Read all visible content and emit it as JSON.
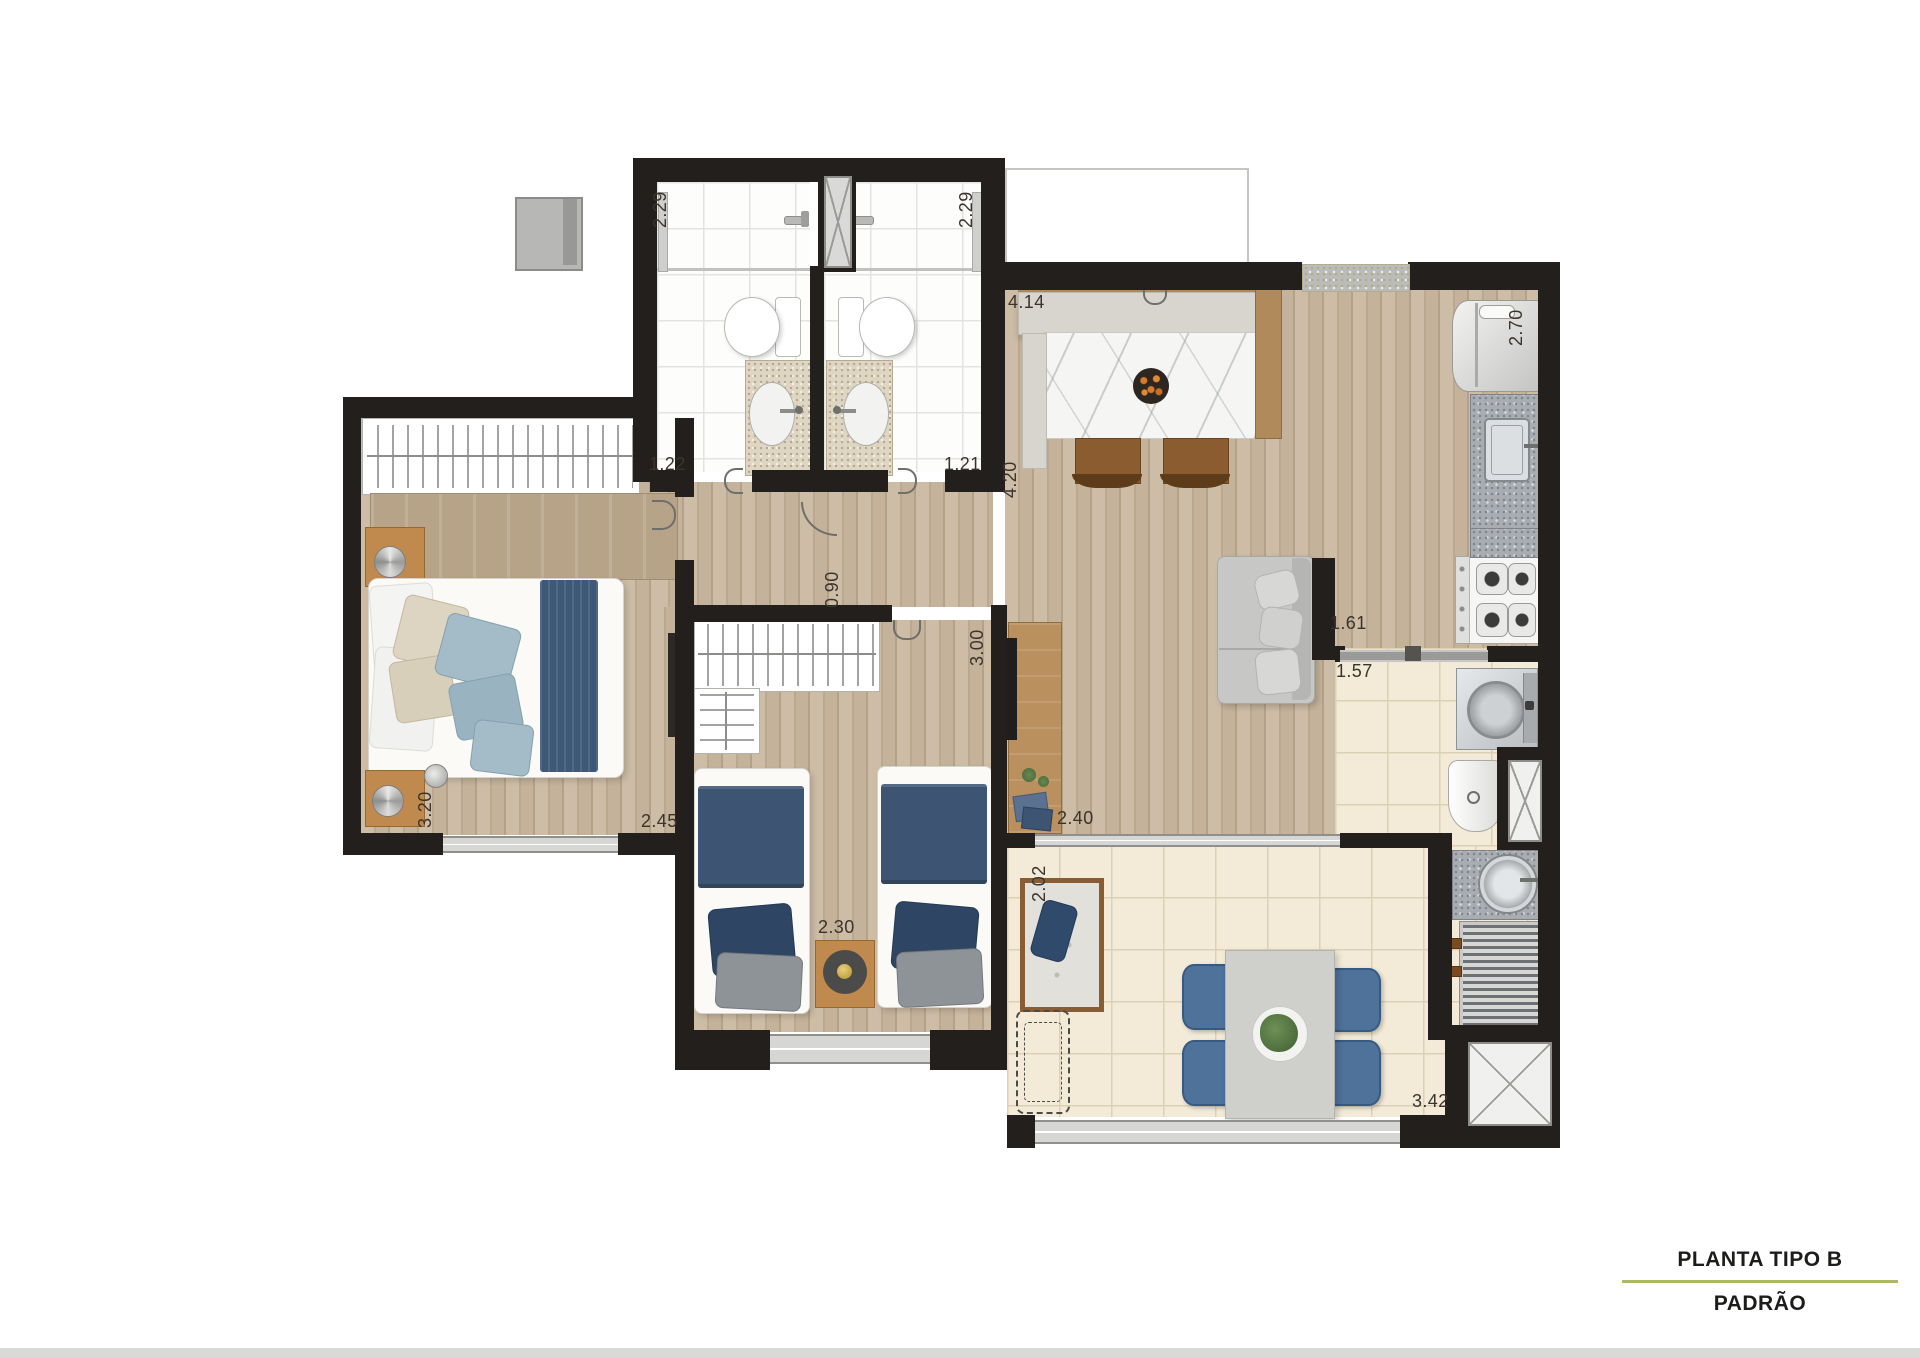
{
  "title_block": {
    "line1": "PLANTA TIPO B",
    "line2": "PADRÃO"
  },
  "dimensions": {
    "bath1_depth": "2.29",
    "bath2_depth": "2.29",
    "bath1_width": "1.22",
    "bath2_width": "1.21",
    "kitchen_width": "4.14",
    "fridge_side": "2.70",
    "kitchen_depth": "4.20",
    "hall_width": "0.90",
    "bedroom2_depth": "3.00",
    "bedroom2_width": "2.30",
    "service_opening_top": "1.61",
    "service_opening_bottom": "1.57",
    "master_depth": "3.20",
    "master_width": "2.45",
    "living_width": "2.40",
    "terrace_depth": "2.02",
    "terrace_width": "3.42"
  },
  "colors": {
    "wall": "#221f1c",
    "wood_floor": "#c9b8a1",
    "tile_floor": "#f3ebd8",
    "navy_textile": "#3d5573",
    "chair_blue": "#4f729b",
    "stool_brown": "#8a5c30",
    "title_divider": "#a9b964"
  }
}
